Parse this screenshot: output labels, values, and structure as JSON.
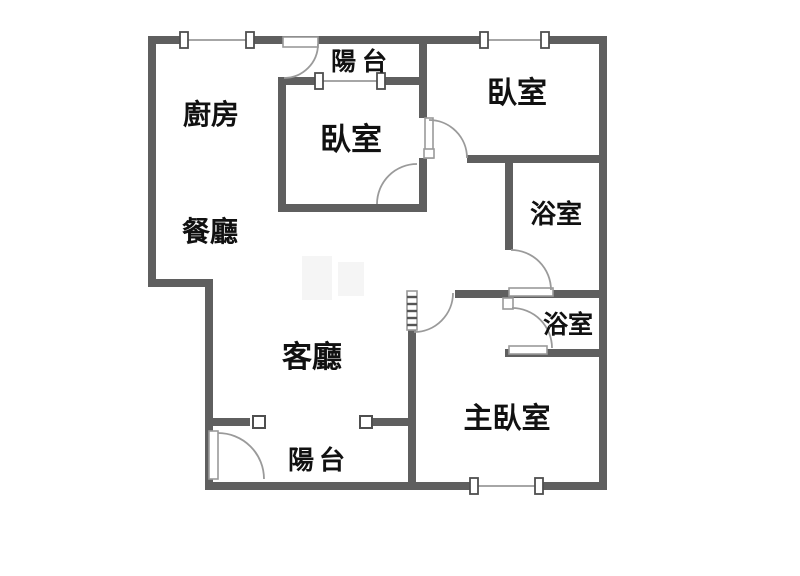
{
  "plan": {
    "colors": {
      "bg": "#ffffff",
      "wall": "#5f5f5f",
      "line": "#9a9a9a",
      "tick": "#4f4f4f",
      "ink": "#111111"
    },
    "rooms": [
      {
        "name": "kitchen",
        "label": "廚房"
      },
      {
        "name": "balcony-top",
        "label": "陽台"
      },
      {
        "name": "bedroom-top-middle",
        "label": "臥室"
      },
      {
        "name": "bedroom-top-right",
        "label": "臥室"
      },
      {
        "name": "dining-room",
        "label": "餐廳"
      },
      {
        "name": "bathroom-upper",
        "label": "浴室"
      },
      {
        "name": "bathroom-lower",
        "label": "浴室"
      },
      {
        "name": "living-room",
        "label": "客廳"
      },
      {
        "name": "master-bedroom",
        "label": "主臥室"
      },
      {
        "name": "balcony-bottom",
        "label": "陽台"
      }
    ]
  }
}
